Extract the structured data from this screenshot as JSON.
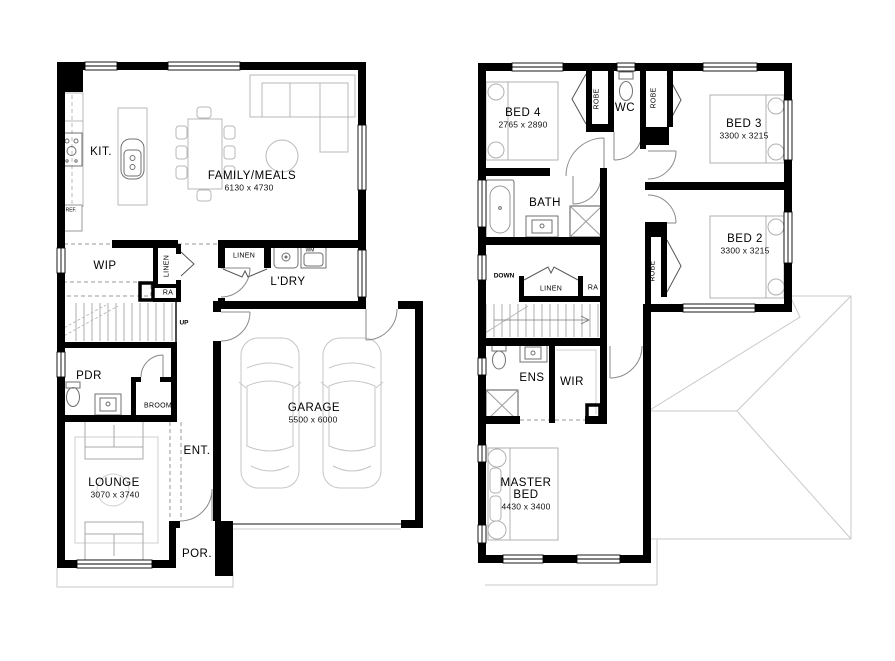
{
  "colors": {
    "wall": "#000000",
    "furniture": "#b8b8b8",
    "fixture": "#707070",
    "roof": "#c9c9c9"
  },
  "ground": {
    "kitchen": {
      "label": "KIT."
    },
    "family": {
      "label": "FAMILY/MEALS",
      "dims": "6130 x 4730"
    },
    "fridge": {
      "label": "REF."
    },
    "wip": {
      "label": "WIP"
    },
    "linen_wip": {
      "label": "LINEN"
    },
    "return_air": {
      "label": "RA"
    },
    "linen_ldry": {
      "label": "LINEN"
    },
    "washing_machine": {
      "label": "WM"
    },
    "laundry": {
      "label": "L'DRY"
    },
    "stairs": {
      "label": "UP"
    },
    "powder": {
      "label": "PDR"
    },
    "broom": {
      "label": "BROOM"
    },
    "entry": {
      "label": "ENT."
    },
    "garage": {
      "label": "GARAGE",
      "dims": "5500 x 6000"
    },
    "lounge": {
      "label": "LOUNGE",
      "dims": "3070 x 3740"
    },
    "porch": {
      "label": "POR."
    }
  },
  "upper": {
    "bed4": {
      "label": "BED 4",
      "dims": "2765 x 2890"
    },
    "robe_bed4": {
      "label": "ROBE"
    },
    "wc": {
      "label": "WC"
    },
    "robe_bed3": {
      "label": "ROBE"
    },
    "bed3": {
      "label": "BED 3",
      "dims": "3300 x 3215"
    },
    "bath": {
      "label": "BATH"
    },
    "bed2": {
      "label": "BED 2",
      "dims": "3300 x 3215"
    },
    "robe_bed2": {
      "label": "ROBE"
    },
    "stairs": {
      "label": "DOWN"
    },
    "linen": {
      "label": "LINEN"
    },
    "return_air": {
      "label": "RA"
    },
    "ensuite": {
      "label": "ENS"
    },
    "wir": {
      "label": "WIR"
    },
    "master": {
      "label": "MASTER BED",
      "dims": "4430 x 3400"
    }
  }
}
